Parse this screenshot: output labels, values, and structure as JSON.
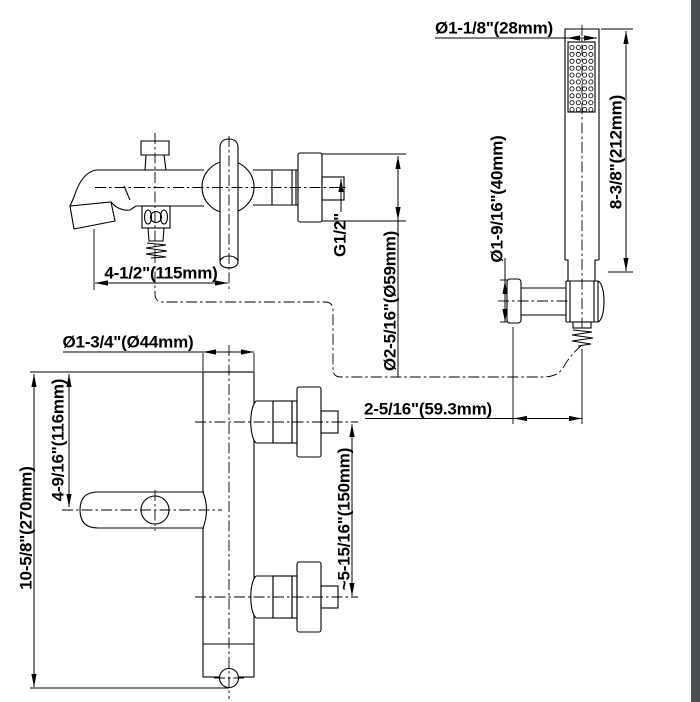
{
  "drawing": {
    "background": "#ffffff",
    "line_color": "#000000",
    "edge_strip_color": "#494d50",
    "dimensions": {
      "head_diameter": "Ø1-1/8\"(28mm)",
      "shower_length": "8-3/8\"(212mm)",
      "holder_diameter": "Ø1-9/16\"(40mm)",
      "thread_size": "G1/2\"",
      "escutcheon_diameter": "Ø2-5/16\"(Ø59mm)",
      "spout_reach": "4-1/2\"(115mm)",
      "hose_offset": "2-5/16\"(59.3mm)",
      "body_diameter": "Ø1-3/4\"(Ø44mm)",
      "handle_height": "4-9/16\"(116mm)",
      "port_spacing": "~5-15/16\"(150mm)",
      "total_height": "10-5/8\"(270mm)"
    }
  }
}
